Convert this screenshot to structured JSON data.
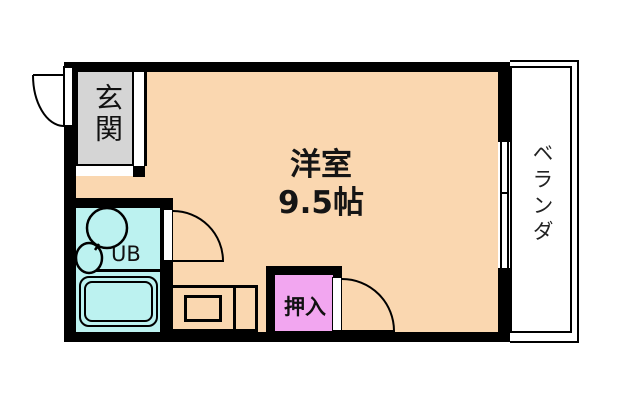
{
  "floorplan": {
    "main_room": {
      "name": "洋室",
      "size": "9.5帖"
    },
    "entrance": {
      "label": "玄関"
    },
    "unit_bath": {
      "label": "UB"
    },
    "closet": {
      "label": "押入"
    },
    "veranda": {
      "label": "ベランダ"
    },
    "colors": {
      "floor": "#FAD7B0",
      "entrance_floor": "#D5D5D5",
      "bath_floor": "#BCF2F0",
      "closet_floor": "#F2A6F0",
      "veranda_floor": "#FFFFFF",
      "wall": "#000000"
    }
  }
}
